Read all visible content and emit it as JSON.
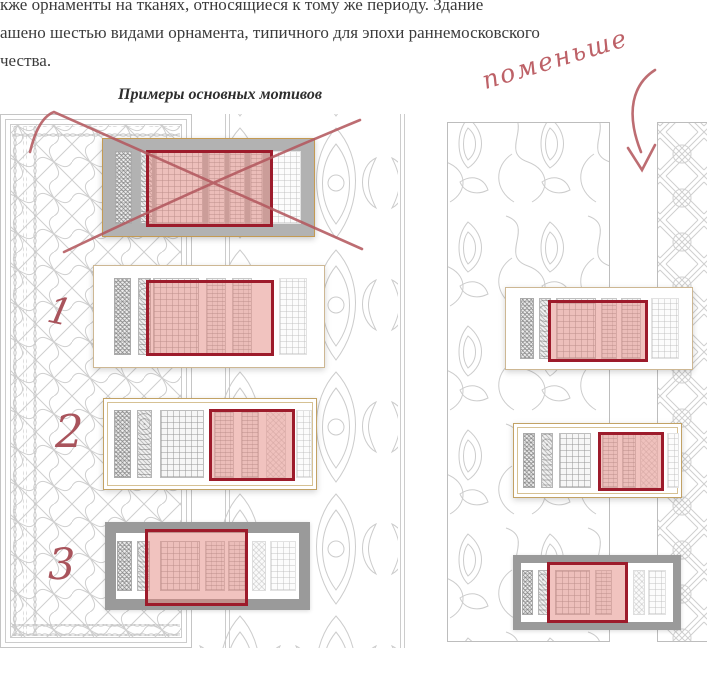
{
  "document": {
    "paragraph_lines": [
      "кже орнаменты на тканях, относящиеся к тому же периоду. Здание",
      "ашено шестью видами орнамента, типичного для эпохи раннемосковского",
      "чества."
    ],
    "caption": "Примеры основных мотивов"
  },
  "annotations": {
    "note": "поменьше",
    "numbers": [
      "1",
      "2",
      "3"
    ],
    "marks": [
      "cross-out-x",
      "down-arrow"
    ]
  },
  "figure": {
    "columns": 2,
    "cards": [
      {
        "id": "card-crossed",
        "column": "left",
        "frame": "gray-plain",
        "crossed_out": true,
        "highlighted": true
      },
      {
        "id": "card-1",
        "column": "left",
        "frame": "plain",
        "crossed_out": false,
        "highlighted": true,
        "label": "1"
      },
      {
        "id": "card-2",
        "column": "left",
        "frame": "ornate",
        "crossed_out": false,
        "highlighted": true,
        "label": "2"
      },
      {
        "id": "card-3",
        "column": "left",
        "frame": "thick-gray",
        "crossed_out": false,
        "highlighted": true,
        "label": "3"
      },
      {
        "id": "card-r1",
        "column": "right",
        "frame": "plain",
        "crossed_out": false,
        "highlighted": true
      },
      {
        "id": "card-r2",
        "column": "right",
        "frame": "ornate",
        "crossed_out": false,
        "highlighted": true
      },
      {
        "id": "card-r3",
        "column": "right",
        "frame": "thick-gray",
        "crossed_out": false,
        "highlighted": true
      }
    ]
  },
  "colors": {
    "highlight_fill": "#e3877f",
    "highlight_border": "#9d1b2b",
    "handwriting_red": "#bd6167",
    "card_border_tan": "#cdb793",
    "crossed_card_fill": "#b2b2b2",
    "thick_frame_gray": "#9a9a9a",
    "pattern_line_gray": "#cccccc",
    "text_color": "#3b3b3b"
  }
}
